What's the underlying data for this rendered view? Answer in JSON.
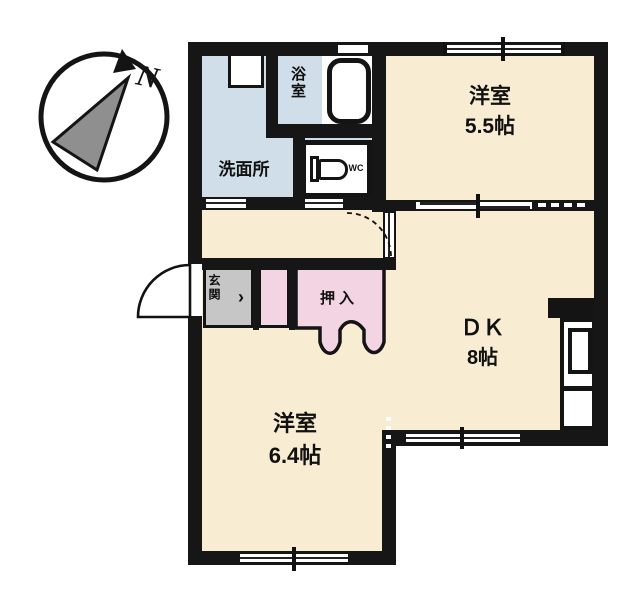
{
  "plan_title": "1DK apartment floor plan",
  "compass": {
    "north_label": "N"
  },
  "rooms": {
    "western_room_1": {
      "name": "洋室",
      "size": "5.5帖"
    },
    "dining_kitchen": {
      "name": "ＤＫ",
      "size": "8帖"
    },
    "western_room_2": {
      "name": "洋室",
      "size": "6.4帖"
    },
    "washroom": {
      "name": "洗面所"
    },
    "bathroom": {
      "name": "浴室"
    },
    "toilet": {
      "name": "WC"
    },
    "entrance": {
      "name": "玄関",
      "step_mark": "›"
    },
    "closet": {
      "name": "押入"
    }
  },
  "colors": {
    "wall": "#161616",
    "room_floor": "#f8edd2",
    "wet_area_floor": "#cfdee9",
    "closet_pink": "#f3d4e2",
    "entrance_gray": "#c6c6c6",
    "background": "#ffffff"
  }
}
